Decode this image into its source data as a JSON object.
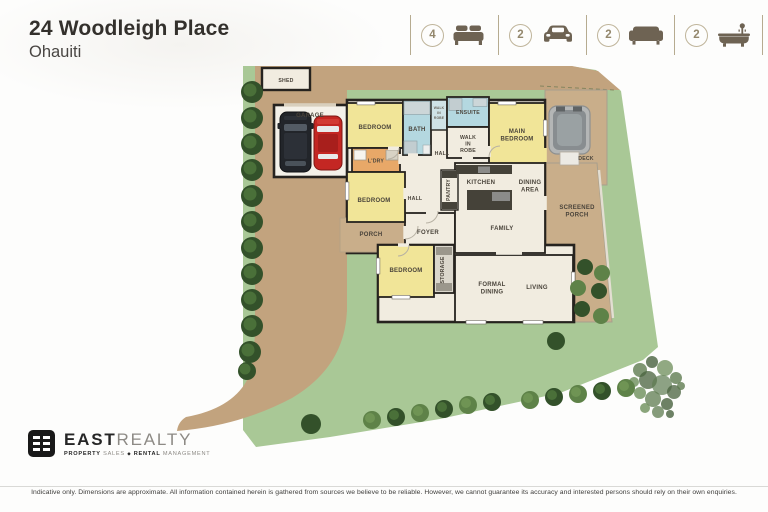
{
  "header": {
    "title": "24 Woodleigh Place",
    "subtitle": "Ohauiti",
    "features": [
      {
        "count": "4",
        "icon": "bed-icon"
      },
      {
        "count": "2",
        "icon": "car-icon"
      },
      {
        "count": "2",
        "icon": "sofa-icon"
      },
      {
        "count": "2",
        "icon": "bath-icon"
      }
    ]
  },
  "floorplan": {
    "rooms": {
      "shed": [
        "SHED"
      ],
      "garage": [
        "GARAGE"
      ],
      "bedroom_top": [
        "BEDROOM"
      ],
      "bath": [
        "BATH"
      ],
      "robe_small": [
        "WALK",
        "IN",
        "ROBE"
      ],
      "ensuite": [
        "ENSUITE"
      ],
      "walk_in_robe": [
        "WALK",
        "IN",
        "ROBE"
      ],
      "main_bedroom": [
        "MAIN",
        "BEDROOM"
      ],
      "deck": [
        "DECK"
      ],
      "laundry": [
        "L'DRY"
      ],
      "hall_upper": [
        "HALL"
      ],
      "hall_lower": [
        "HALL"
      ],
      "pantry": [
        "PANTRY"
      ],
      "kitchen": [
        "KITCHEN"
      ],
      "dining_area": [
        "DINING",
        "AREA"
      ],
      "family": [
        "FAMILY"
      ],
      "screened_porch": [
        "SCREENED",
        "PORCH"
      ],
      "bedroom_mid": [
        "BEDROOM"
      ],
      "porch": [
        "PORCH"
      ],
      "foyer": [
        "FOYER"
      ],
      "bedroom_bottom": [
        "BEDROOM"
      ],
      "storage": [
        "STORAGE"
      ],
      "formal_dining": [
        "FORMAL",
        "DINING"
      ],
      "living": [
        "LIVING"
      ]
    }
  },
  "footer": {
    "brand_bold": "EAST",
    "brand_light": "REALTY",
    "tagline": {
      "w1": "PROPERTY",
      "w2": "SALES",
      "sep": "◆",
      "w3": "RENTAL",
      "w4": "MANAGEMENT"
    },
    "disclaimer": "Indicative only. Dimensions are approximate. All information contained herein is gathered from sources we believe to be reliable. However, we cannot guarantee its accuracy and interested persons should rely on their own enquiries."
  },
  "colors": {
    "lawn": "#a9c896",
    "driveway": "#c2a37e",
    "tan_deck": "#c9ae8a",
    "floor": "#f1ece0",
    "bedroom": "#f1e598",
    "wet": "#b4d8e0",
    "laundry_orange": "#e8a868",
    "wall": "#26231f",
    "icon_brown": "#6e6353",
    "tree_dark": "#33512a",
    "tree_light": "#5e8248"
  }
}
